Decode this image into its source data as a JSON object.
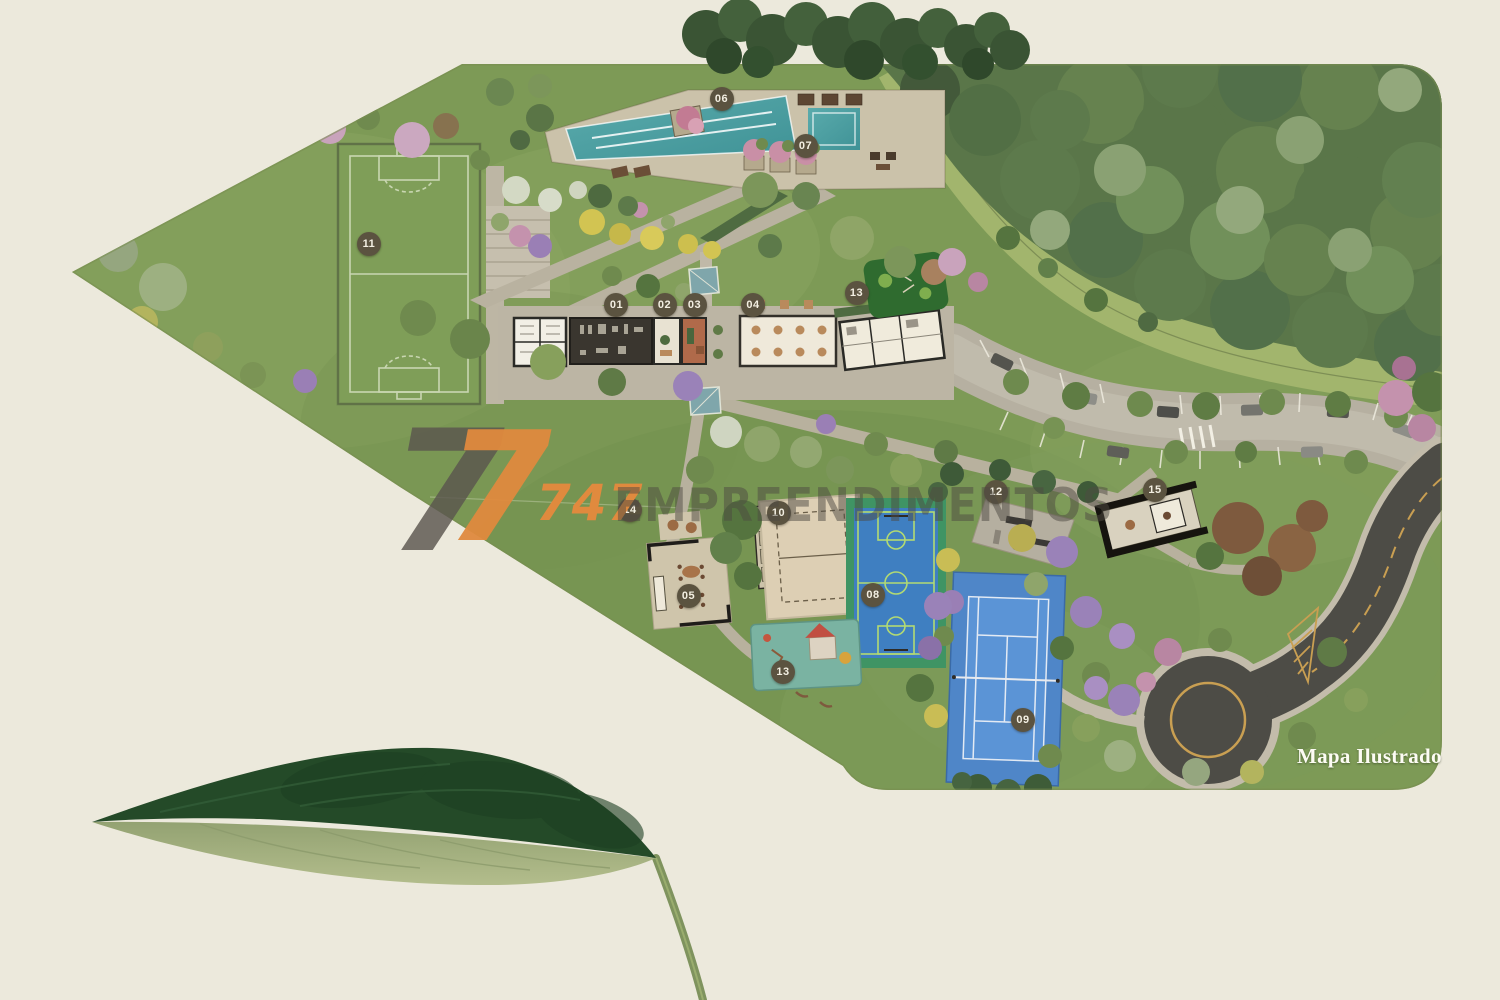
{
  "map": {
    "caption": "Mapa Ilustrado",
    "markers": [
      {
        "label": "01",
        "x": 41.1,
        "y": 30.5
      },
      {
        "label": "02",
        "x": 44.3,
        "y": 30.5
      },
      {
        "label": "03",
        "x": 46.3,
        "y": 30.5
      },
      {
        "label": "04",
        "x": 50.2,
        "y": 30.5
      },
      {
        "label": "05",
        "x": 45.9,
        "y": 59.6
      },
      {
        "label": "06",
        "x": 48.1,
        "y": 9.9
      },
      {
        "label": "07",
        "x": 53.7,
        "y": 14.6
      },
      {
        "label": "08",
        "x": 58.2,
        "y": 59.5
      },
      {
        "label": "09",
        "x": 68.2,
        "y": 72.0
      },
      {
        "label": "10",
        "x": 51.9,
        "y": 51.3
      },
      {
        "label": "11",
        "x": 24.6,
        "y": 24.4
      },
      {
        "label": "12",
        "x": 66.4,
        "y": 49.2
      },
      {
        "label": "13",
        "x": 57.1,
        "y": 29.3
      },
      {
        "label": "13",
        "x": 52.2,
        "y": 67.2
      },
      {
        "label": "14",
        "x": 42.0,
        "y": 51.0
      },
      {
        "label": "15",
        "x": 77.0,
        "y": 49.0
      }
    ]
  },
  "watermark": {
    "glyph_back": "7",
    "glyph_front": "7",
    "number": "747",
    "company": "EMPREENDIMENTOS"
  },
  "colors": {
    "background": "#ece9dc",
    "map_grass": "#7d9a56",
    "marker_bg": "#5b5340",
    "brand_orange": "#e08a3e",
    "watermark_gray": "rgba(90,86,78,0.82)",
    "company_text": "rgba(78,74,66,0.5)",
    "caption_text": "#fdfcf4"
  }
}
